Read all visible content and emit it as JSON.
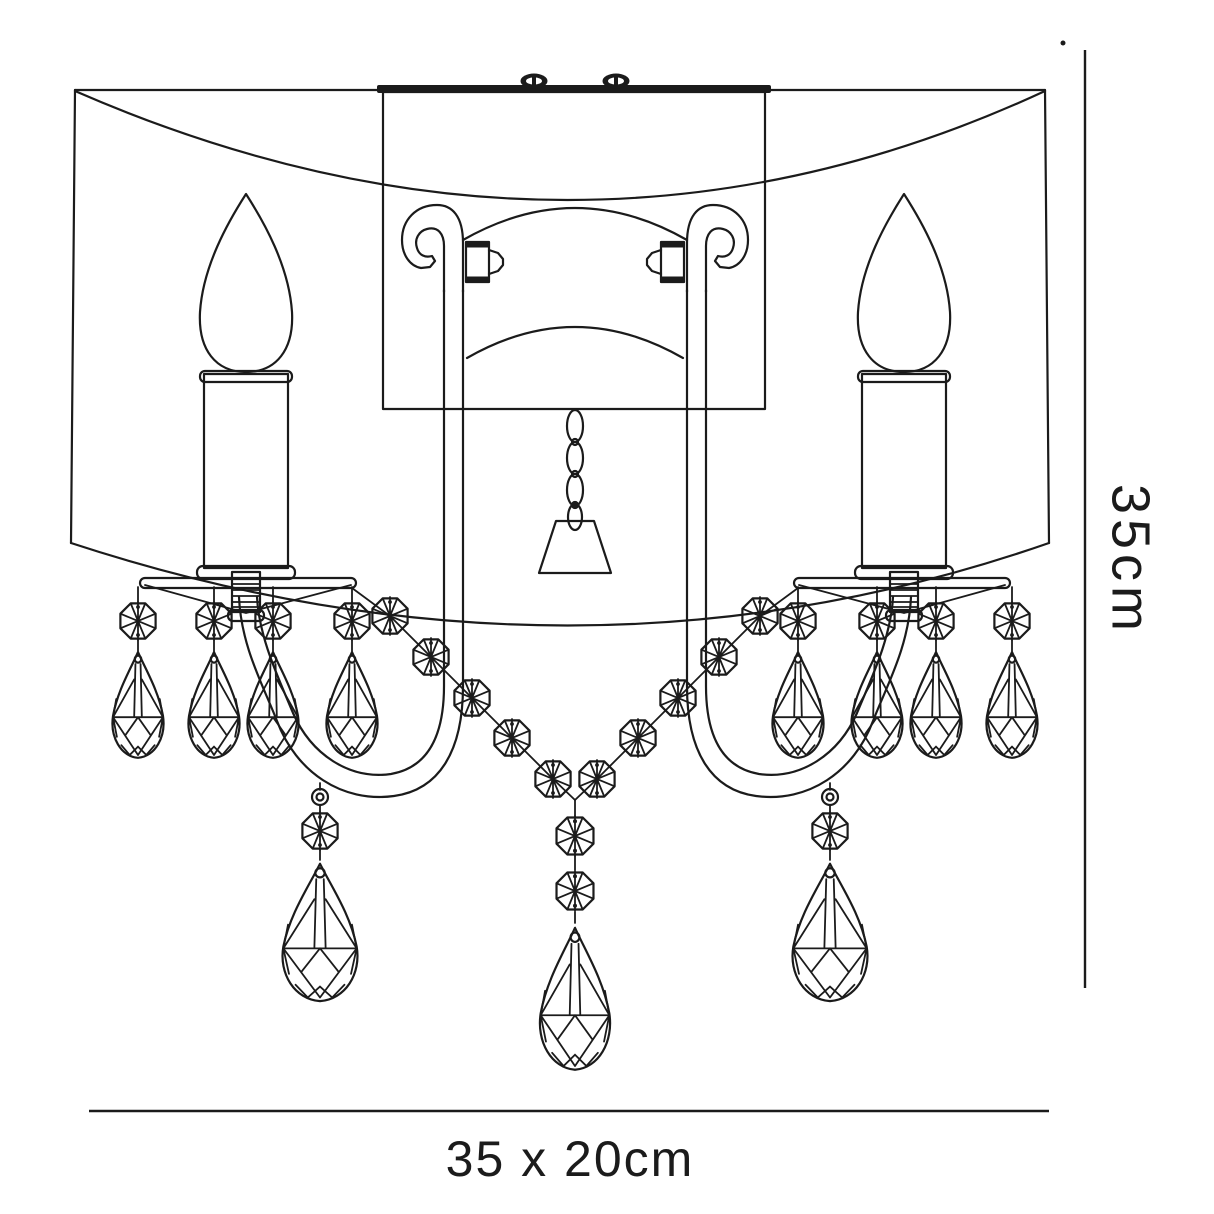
{
  "diagram": {
    "type": "product-dimension-line-drawing",
    "subject": "double crystal wall light",
    "labels": {
      "height": "35cm",
      "size": "35 x 20cm"
    },
    "colors": {
      "line": "#1b1b1b",
      "background": "#ffffff"
    }
  }
}
